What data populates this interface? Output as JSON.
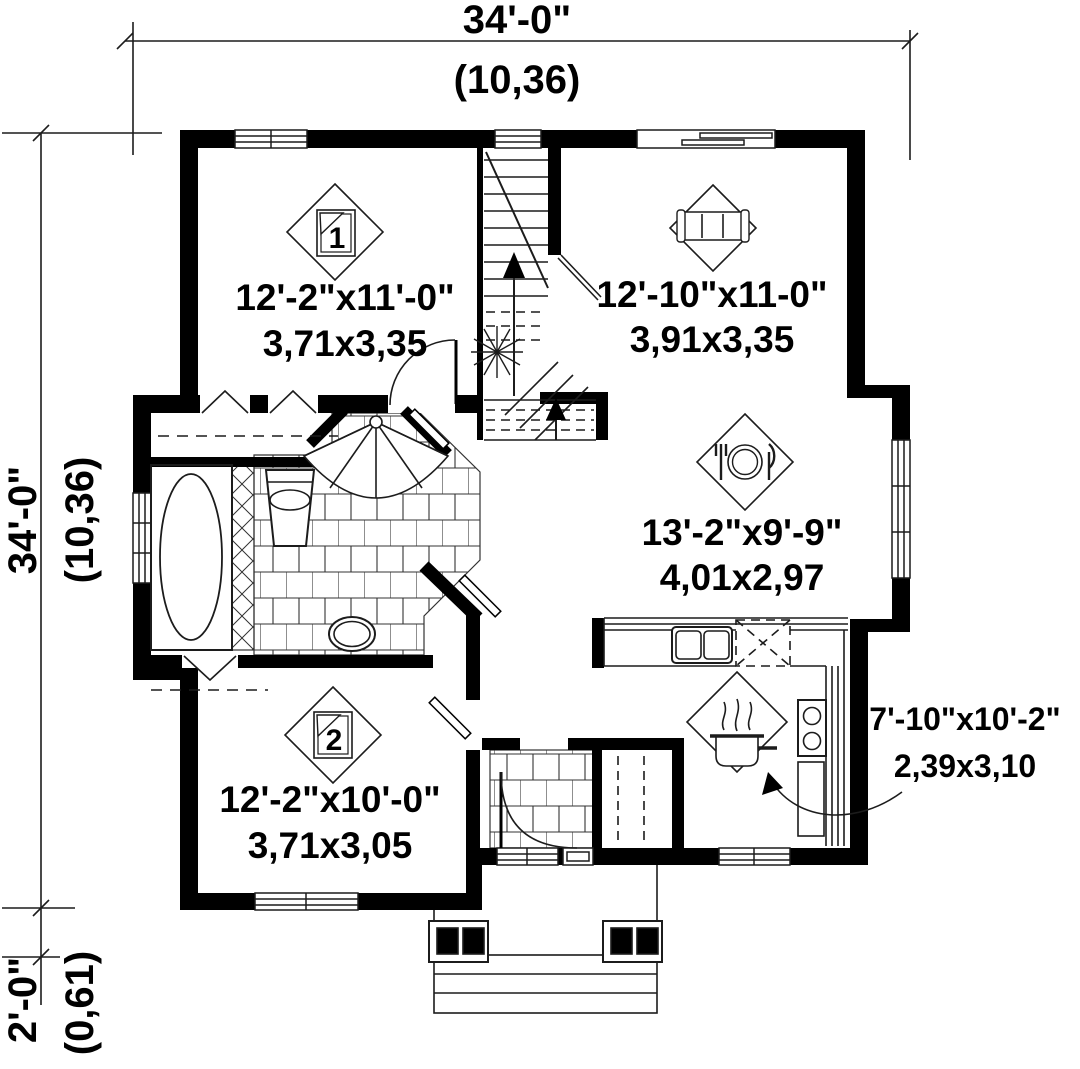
{
  "title": "House first floor plan",
  "dimensions": {
    "top": {
      "imperial": "34'-0\"",
      "metric": "(10,36)"
    },
    "left": {
      "imperial": "34'-0\"",
      "metric": "(10,36)"
    },
    "porch": {
      "imperial": "2'-0\"",
      "metric": "(0,61)"
    }
  },
  "rooms": [
    {
      "name": "bedroom-1",
      "icon": "bed-1-icon",
      "number": "1",
      "imperial": "12'-2\"x11'-0\"",
      "metric": "3,71x3,35"
    },
    {
      "name": "living-room",
      "icon": "sofa-icon",
      "imperial": "12'-10\"x11-0\"",
      "metric": "3,91x3,35"
    },
    {
      "name": "dining-room",
      "icon": "dining-plate-icon",
      "imperial": "13'-2\"x9'-9\"",
      "metric": "4,01x2,97"
    },
    {
      "name": "kitchen",
      "icon": "cooking-pot-icon",
      "imperial": "7'-10\"x10'-2\"",
      "metric": "2,39x3,10"
    },
    {
      "name": "bedroom-2",
      "icon": "bed-2-icon",
      "number": "2",
      "imperial": "12'-2\"x10'-0\"",
      "metric": "3,71x3,05"
    }
  ],
  "colors": {
    "wall": "#000000",
    "line": "#1c1c1c",
    "background": "#ffffff"
  }
}
